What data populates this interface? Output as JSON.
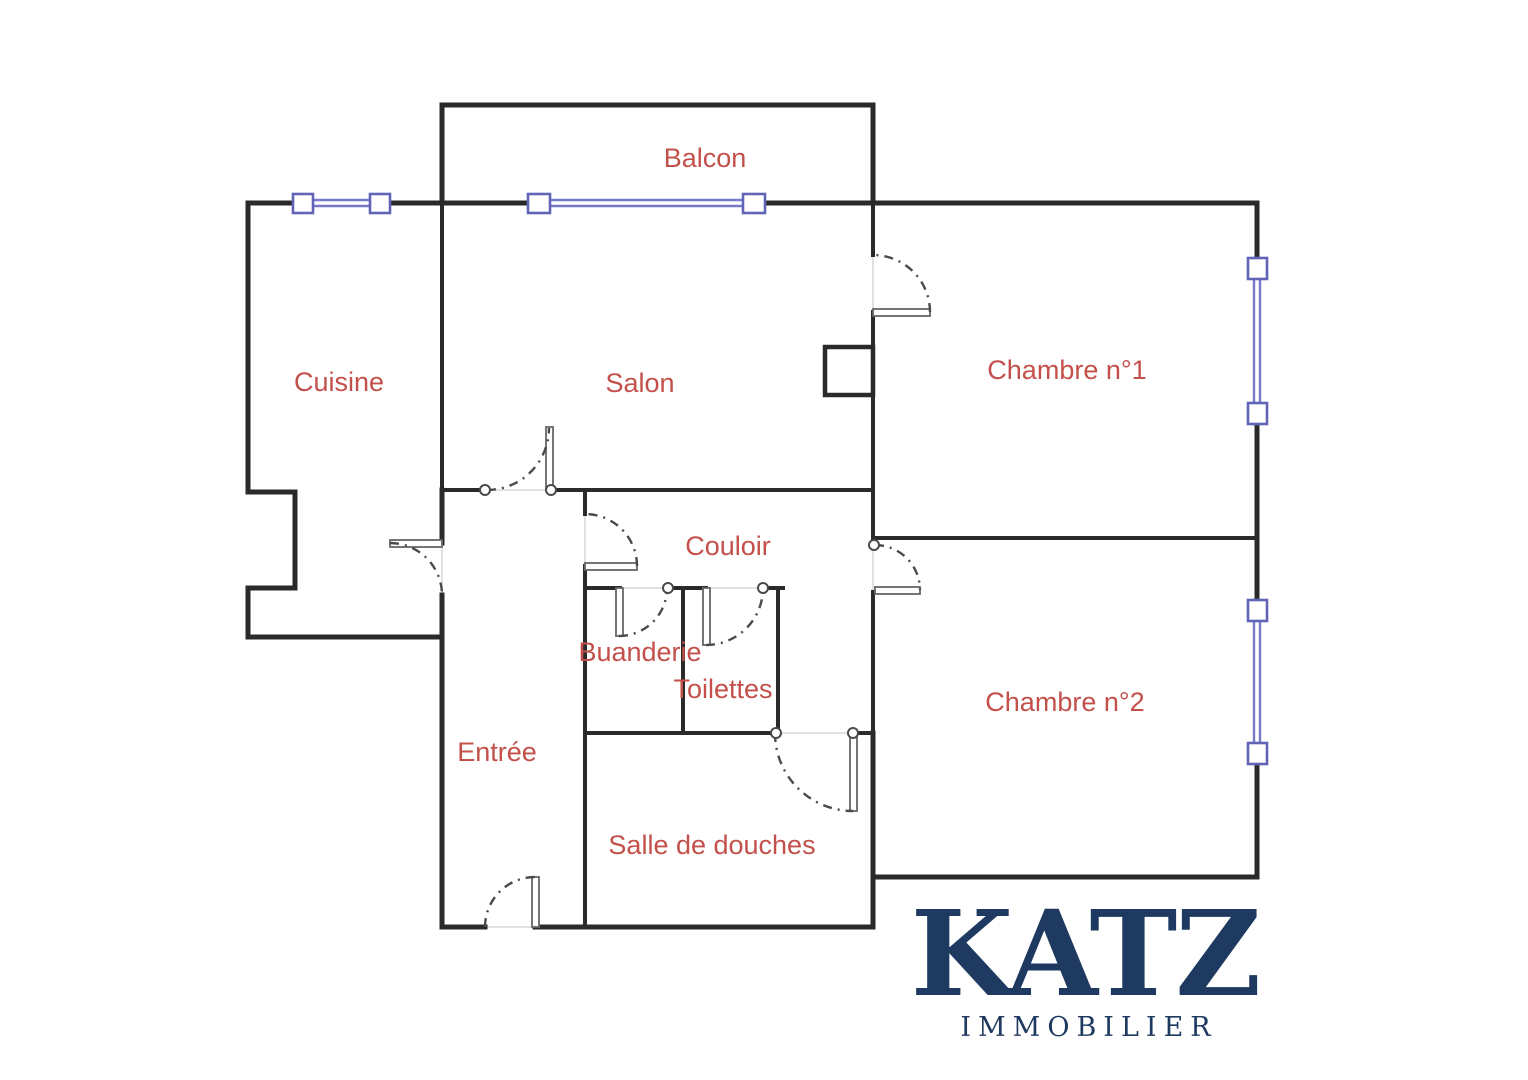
{
  "colors": {
    "bg": "#ffffff",
    "wall": "#2a2a2a",
    "door": "#666666",
    "arc": "#4a4a4a",
    "ghost": "#cfcfcf",
    "window": "#7678c8",
    "window_border": "#6164b6",
    "label": "#c3504a",
    "logo": "#1f3a60"
  },
  "floorplan": {
    "rooms": [
      {
        "name": "balcon",
        "label": "Balcon"
      },
      {
        "name": "cuisine",
        "label": "Cuisine"
      },
      {
        "name": "salon",
        "label": "Salon"
      },
      {
        "name": "chambre-1",
        "label": "Chambre n°1"
      },
      {
        "name": "chambre-2",
        "label": "Chambre n°2"
      },
      {
        "name": "couloir",
        "label": "Couloir"
      },
      {
        "name": "buanderie",
        "label": "Buanderie"
      },
      {
        "name": "toilettes",
        "label": "Toilettes"
      },
      {
        "name": "entree",
        "label": "Entrée"
      },
      {
        "name": "salle-de-douches",
        "label": "Salle de douches"
      }
    ]
  },
  "logo": {
    "brand": "KATZ",
    "tagline": "IMMOBILIER"
  }
}
